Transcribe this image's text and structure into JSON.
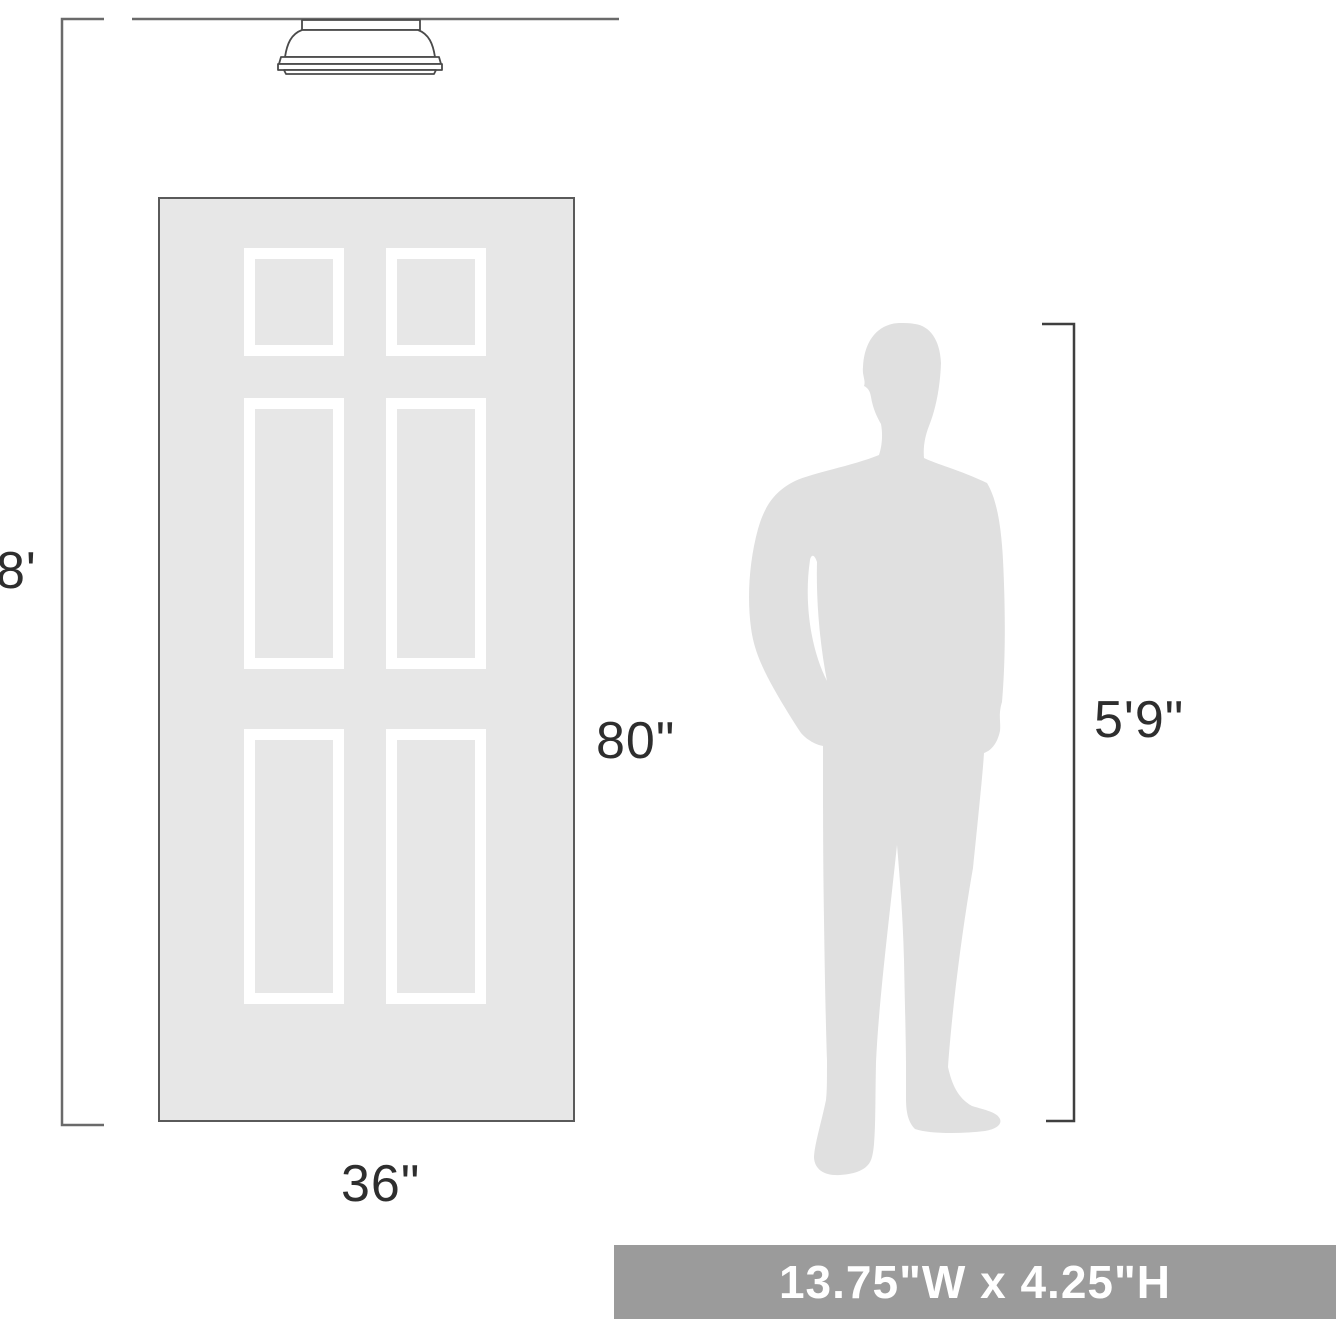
{
  "diagram": {
    "ceiling_height": "8'",
    "door_height": "80\"",
    "door_width": "36\"",
    "person_height": "5'9\"",
    "product_dimensions": "13.75\"W x 4.25\"H"
  },
  "icons": {
    "fixture": "flushmount-ceiling-light-icon",
    "person": "person-silhouette",
    "door": "six-panel-door-graphic"
  },
  "colors": {
    "line": "#6a6a6a",
    "bracket_dark": "#3f3f3f",
    "fixture_stroke": "#4a4a4a",
    "label": "#2e2e2e",
    "door_fill": "#e7e7e7",
    "door_border": "#5a5a5a",
    "panel": "#ffffff",
    "silhouette": "#e0e0e0",
    "banner_bg": "#9b9b9b",
    "banner_text": "#ffffff"
  }
}
